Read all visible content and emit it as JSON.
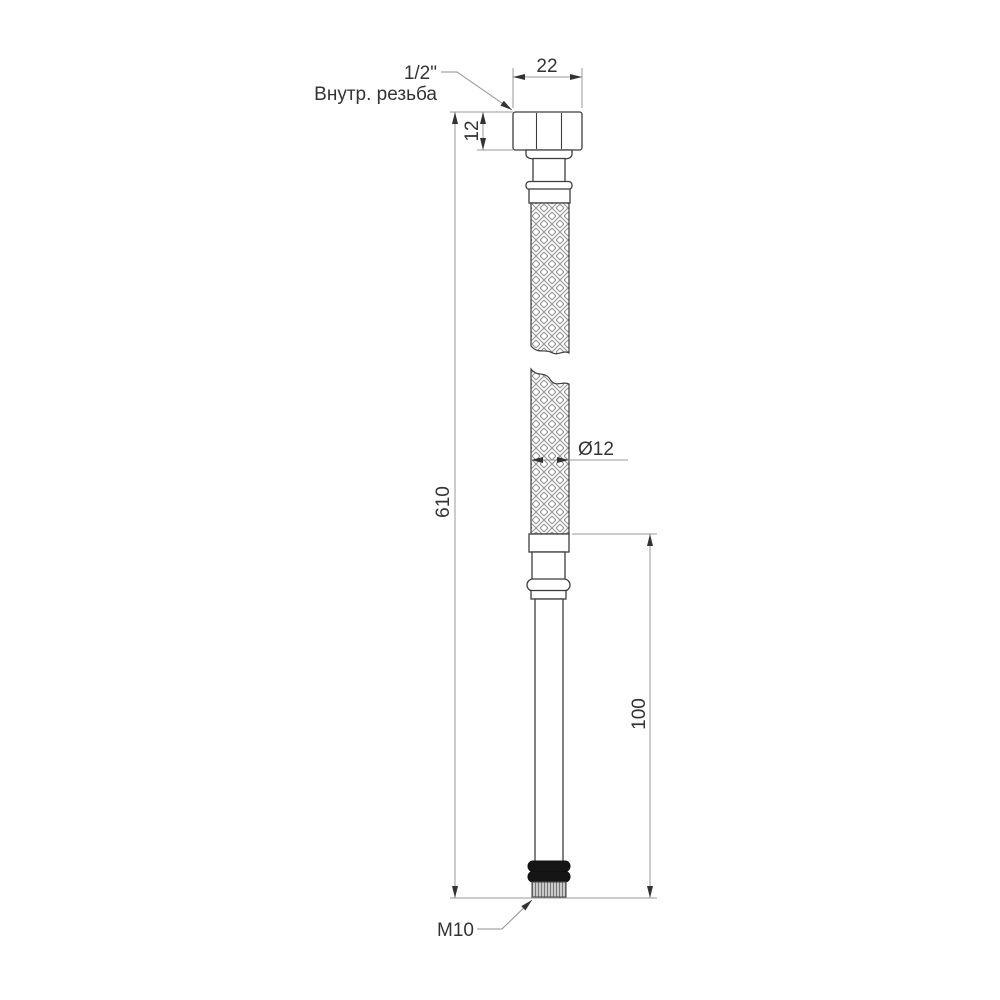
{
  "diagram": {
    "type": "technical-drawing",
    "subject": "flexible-braided-hose",
    "labels": {
      "top_thread_size": "1/2\"",
      "top_thread_type": "Внутр. резьба",
      "nut_width": "22",
      "nut_height": "12",
      "overall_length": "610",
      "hose_diameter": "Ø12",
      "tube_length": "100",
      "bottom_thread": "M10"
    },
    "colors": {
      "background": "#ffffff",
      "part_outline": "#3d3d3d",
      "dimension_line": "#9a9a9a",
      "text": "#333333",
      "arrow": "#333333",
      "braid_line": "#8c8c8c",
      "thread_hatch": "#787878",
      "oring_fill": "#151515"
    }
  }
}
